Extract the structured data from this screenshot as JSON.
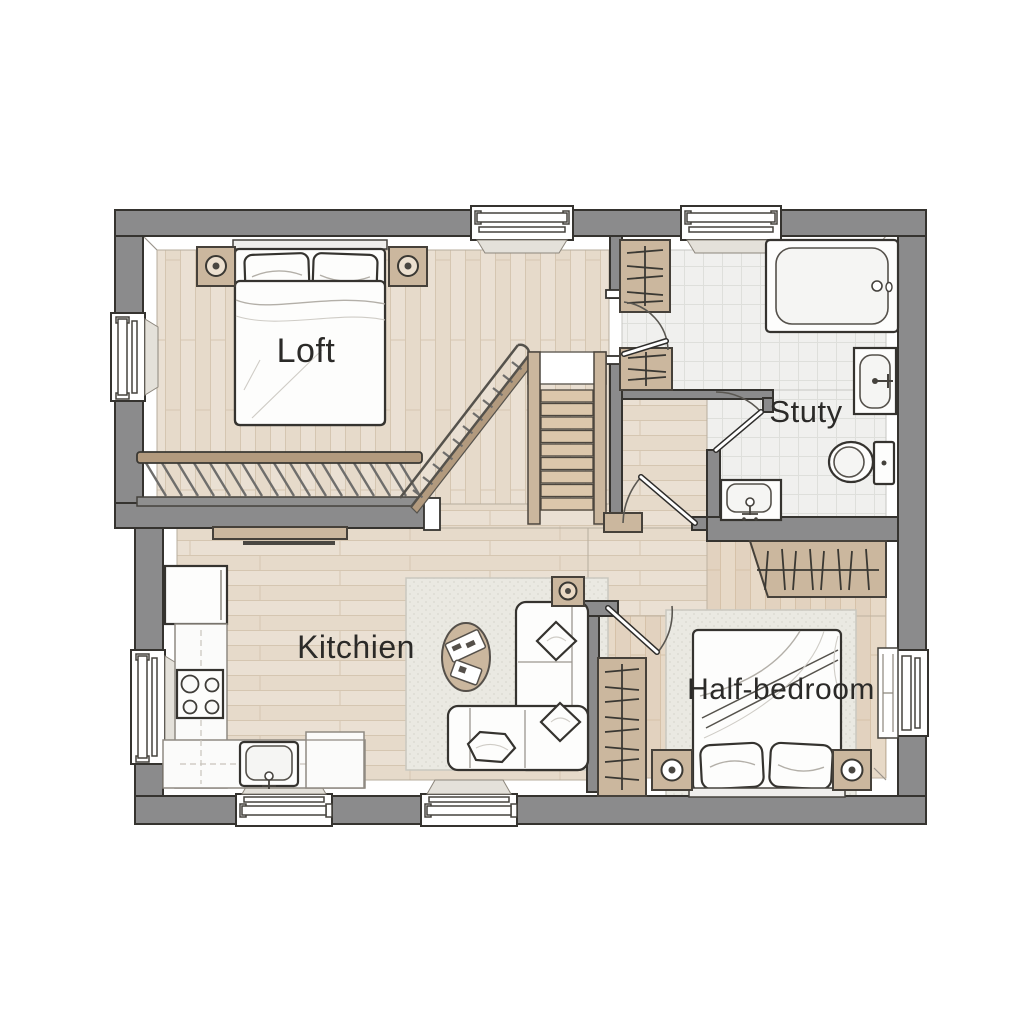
{
  "plan": {
    "rooms": {
      "loft": {
        "label": "Loft"
      },
      "study": {
        "label": "Stuty"
      },
      "kitchen": {
        "label": "Kitchien"
      },
      "half_bedroom": {
        "label": "Half-bedroom"
      }
    }
  },
  "colors": {
    "wall": "#8b8b8c",
    "outline": "#35332f",
    "wood": "#eae0d3",
    "wood_line": "#d5c6b1",
    "wood_dark": "#e1d3c1",
    "bedwood": "#e7d9c7",
    "bedwood_line": "#d6c2a9",
    "tile": "#f0f0ee",
    "tile_line": "#dedfdb",
    "closet": "#cbb79e",
    "stair": "#dcc7ab",
    "rail_wood": "#b29a7e",
    "rug": "#eae9e2",
    "rug_dot": "#d9d8cf",
    "fixture": "#fdfdfc",
    "fixture_inner": "#f5f5f3",
    "label": "#2b2a28",
    "sill": "#e4e1da"
  }
}
